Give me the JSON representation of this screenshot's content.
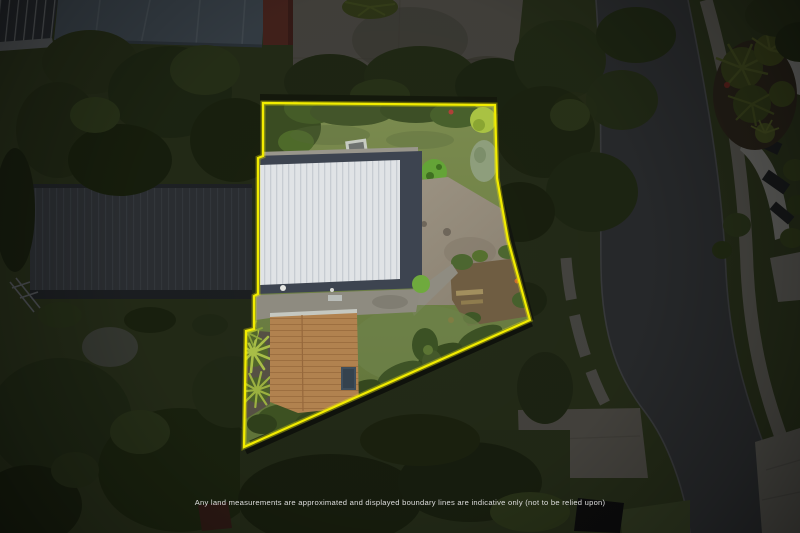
{
  "disclaimer": {
    "text": "Any land measurements are approximated and displayed boundary lines are indicative only (not to be relied upon)"
  },
  "boundary": {
    "color": "#f2ec00",
    "stroke_width": "2.2",
    "points": "263,103 495,105 497,178 508,240 530,320 244,447 246,331 254,329 254,296 258,294 258,158 263,156"
  }
}
